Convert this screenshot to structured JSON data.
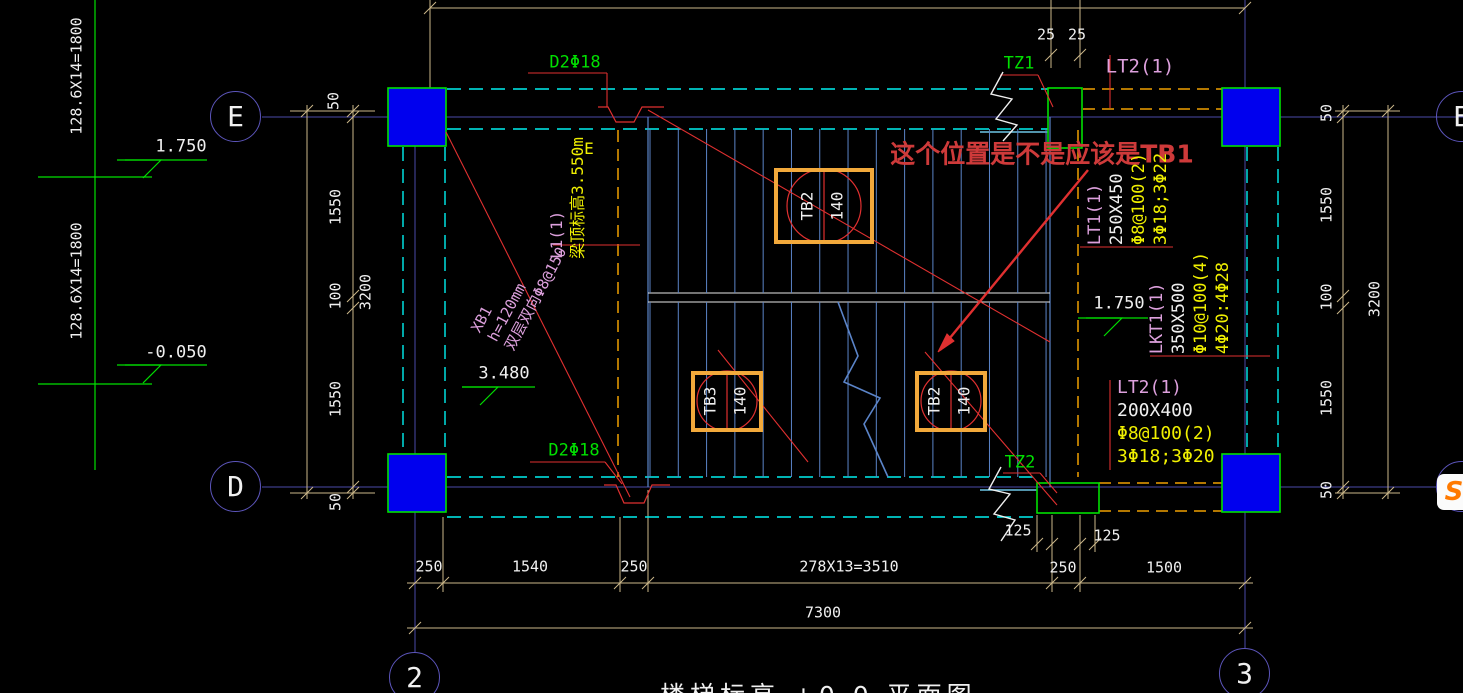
{
  "title_partial": "楼梯标高 +0.0 平面图",
  "overlay_icon": {
    "letter": "S"
  },
  "colors": {
    "background": "#000000",
    "grid": "#4A4AA8",
    "dim": "#CDB88A",
    "text": "#F0F0F0",
    "green": "#00E000",
    "red": "#E03030",
    "pink": "#DDA0DD",
    "yellow": "#F0F000",
    "cyan": "#00F0F0",
    "orange_dash": "#F0A000",
    "tb_border": "#F2A93B",
    "tread_blue": "#5B84C8",
    "column_fill": "#0000EE",
    "note_red": "#CE3A3A"
  },
  "grid_bubbles": [
    {
      "name": "grid-E-left",
      "label": "E",
      "cx": 236,
      "cy": 117
    },
    {
      "name": "grid-D-left",
      "label": "D",
      "cx": 236,
      "cy": 487
    },
    {
      "name": "grid-2",
      "label": "2",
      "cx": 415,
      "cy": 678
    },
    {
      "name": "grid-3",
      "label": "3",
      "cx": 1245,
      "cy": 674
    },
    {
      "name": "grid-E-right",
      "label": "E",
      "cx": 1462,
      "cy": 117
    },
    {
      "name": "grid-D-right",
      "label": "D",
      "cx": 1462,
      "cy": 487
    }
  ],
  "labels": [
    {
      "name": "riser-calc-top",
      "t": "128.6X14=1800",
      "x": 77,
      "y": 76,
      "rot": -90,
      "c": "#F0F0F0",
      "s": 15
    },
    {
      "name": "riser-calc-bottom",
      "t": "128.6X14=1800",
      "x": 77,
      "y": 281,
      "rot": -90,
      "c": "#F0F0F0",
      "s": 15
    },
    {
      "name": "level-1750-left",
      "t": "1.750",
      "x": 181,
      "y": 147,
      "rot": 0,
      "c": "#F0F0F0",
      "s": 17
    },
    {
      "name": "level-neg-0050",
      "t": "-0.050",
      "x": 176,
      "y": 353,
      "rot": 0,
      "c": "#F0F0F0",
      "s": 17
    },
    {
      "name": "level-3480",
      "t": "3.480",
      "x": 504,
      "y": 374,
      "rot": 0,
      "c": "#F0F0F0",
      "s": 17
    },
    {
      "name": "level-1750-right",
      "t": "1.750",
      "x": 1119,
      "y": 304,
      "rot": 0,
      "c": "#F0F0F0",
      "s": 17
    },
    {
      "name": "dim-50-left-top",
      "t": "50",
      "x": 334,
      "y": 101,
      "rot": -90,
      "c": "#F0F0F0",
      "s": 15
    },
    {
      "name": "dim-1550-left-top",
      "t": "1550",
      "x": 336,
      "y": 207,
      "rot": -90,
      "c": "#F0F0F0",
      "s": 15
    },
    {
      "name": "dim-100-left",
      "t": "100",
      "x": 336,
      "y": 296,
      "rot": -90,
      "c": "#F0F0F0",
      "s": 15
    },
    {
      "name": "dim-1550-left-bot",
      "t": "1550",
      "x": 336,
      "y": 399,
      "rot": -90,
      "c": "#F0F0F0",
      "s": 15
    },
    {
      "name": "dim-50-left-bot",
      "t": "50",
      "x": 336,
      "y": 502,
      "rot": -90,
      "c": "#F0F0F0",
      "s": 15
    },
    {
      "name": "dim-3200-left",
      "t": "3200",
      "x": 366,
      "y": 292,
      "rot": -90,
      "c": "#F0F0F0",
      "s": 15
    },
    {
      "name": "dim-50-right-top",
      "t": "50",
      "x": 1327,
      "y": 113,
      "rot": -90,
      "c": "#F0F0F0",
      "s": 15
    },
    {
      "name": "dim-1550-right-top",
      "t": "1550",
      "x": 1327,
      "y": 205,
      "rot": -90,
      "c": "#F0F0F0",
      "s": 15
    },
    {
      "name": "dim-100-right",
      "t": "100",
      "x": 1327,
      "y": 297,
      "rot": -90,
      "c": "#F0F0F0",
      "s": 15
    },
    {
      "name": "dim-1550-right-bot",
      "t": "1550",
      "x": 1327,
      "y": 398,
      "rot": -90,
      "c": "#F0F0F0",
      "s": 15
    },
    {
      "name": "dim-50-right-bot",
      "t": "50",
      "x": 1327,
      "y": 490,
      "rot": -90,
      "c": "#F0F0F0",
      "s": 15
    },
    {
      "name": "dim-3200-right",
      "t": "3200",
      "x": 1375,
      "y": 299,
      "rot": -90,
      "c": "#F0F0F0",
      "s": 15
    },
    {
      "name": "dim-25-a",
      "t": "25",
      "x": 1046,
      "y": 35,
      "rot": 0,
      "c": "#F0F0F0",
      "s": 15
    },
    {
      "name": "dim-25-b",
      "t": "25",
      "x": 1077,
      "y": 35,
      "rot": 0,
      "c": "#F0F0F0",
      "s": 15
    },
    {
      "name": "dim-250-a",
      "t": "250",
      "x": 429,
      "y": 567,
      "rot": 0,
      "c": "#F0F0F0",
      "s": 15
    },
    {
      "name": "dim-1540",
      "t": "1540",
      "x": 530,
      "y": 567,
      "rot": 0,
      "c": "#F0F0F0",
      "s": 15
    },
    {
      "name": "dim-250-b",
      "t": "250",
      "x": 634,
      "y": 567,
      "rot": 0,
      "c": "#F0F0F0",
      "s": 15
    },
    {
      "name": "dim-tread-run",
      "t": "278X13=3510",
      "x": 849,
      "y": 567,
      "rot": 0,
      "c": "#F0F0F0",
      "s": 15
    },
    {
      "name": "dim-250-c",
      "t": "250",
      "x": 1063,
      "y": 568,
      "rot": 0,
      "c": "#F0F0F0",
      "s": 15
    },
    {
      "name": "dim-1500",
      "t": "1500",
      "x": 1164,
      "y": 568,
      "rot": 0,
      "c": "#F0F0F0",
      "s": 15
    },
    {
      "name": "dim-7300",
      "t": "7300",
      "x": 823,
      "y": 613,
      "rot": 0,
      "c": "#F0F0F0",
      "s": 15
    },
    {
      "name": "dim-125-a",
      "t": "125",
      "x": 1018,
      "y": 531,
      "rot": 0,
      "c": "#F0F0F0",
      "s": 15
    },
    {
      "name": "dim-125-b",
      "t": "125",
      "x": 1107,
      "y": 536,
      "rot": 0,
      "c": "#F0F0F0",
      "s": 15
    },
    {
      "name": "rebar-d2-top",
      "t": "D2Φ18",
      "x": 575,
      "y": 63,
      "rot": 0,
      "c": "#00E000",
      "s": 17
    },
    {
      "name": "rebar-d2-bottom",
      "t": "D2Φ18",
      "x": 574,
      "y": 451,
      "rot": 0,
      "c": "#00E000",
      "s": 17
    },
    {
      "name": "col-tz1",
      "t": "TZ1",
      "x": 1019,
      "y": 64,
      "rot": 0,
      "c": "#00E000",
      "s": 17
    },
    {
      "name": "col-tz2",
      "t": "TZ2",
      "x": 1020,
      "y": 463,
      "rot": 0,
      "c": "#00E000",
      "s": 17
    },
    {
      "name": "beam-lt2-top-tag",
      "t": "LT2(1)",
      "x": 1140,
      "y": 67,
      "rot": 0,
      "c": "#DDA0DD",
      "s": 19
    },
    {
      "name": "question-note",
      "t": "这个位置是不是应该是TB1",
      "x": 1042,
      "y": 154,
      "rot": 0,
      "c": "#CE3A3A",
      "s": 25,
      "b": 1
    },
    {
      "name": "label-e-yellow",
      "t": "E",
      "x": 589,
      "y": 149,
      "rot": 0,
      "c": "#F0F000",
      "s": 16
    }
  ],
  "blocks": [
    {
      "name": "beam-lt1-spec",
      "x": 1131,
      "y": 199,
      "rot": -90,
      "lh": 22,
      "s": 17,
      "lines": [
        {
          "t": "LT1(1)",
          "c": "#DDA0DD"
        },
        {
          "t": "250X450",
          "c": "#F0F0F0"
        },
        {
          "t": "Φ8@100(2)",
          "c": "#F0F000"
        },
        {
          "t": "3Φ18;3Φ22",
          "c": "#F0F000"
        }
      ]
    },
    {
      "name": "beam-lkt1-spec",
      "x": 1193,
      "y": 303,
      "rot": -90,
      "lh": 22,
      "s": 17,
      "lines": [
        {
          "t": "LKT1(1)",
          "c": "#DDA0DD"
        },
        {
          "t": "350X500",
          "c": "#F0F0F0"
        },
        {
          "t": "Φ10@100(4)",
          "c": "#F0F000"
        },
        {
          "t": "4Φ20:4Φ28",
          "c": "#F0F000"
        }
      ]
    },
    {
      "name": "beam-lt2-spec",
      "x": 1117,
      "y": 379,
      "rot": 0,
      "lh": 23,
      "s": 18,
      "anchor": "tl",
      "lines": [
        {
          "t": "LT2(1)",
          "c": "#DDA0DD"
        },
        {
          "t": "200X400",
          "c": "#F0F0F0"
        },
        {
          "t": "Φ8@100(2)",
          "c": "#F0F000"
        },
        {
          "t": "3Φ18;3Φ20",
          "c": "#F0F000"
        }
      ]
    },
    {
      "name": "beam-l1-spec",
      "x": 570,
      "y": 198,
      "rot": -90,
      "lh": 21,
      "s": 16,
      "lines": [
        {
          "t": "L1(1)",
          "c": "#DDA0DD"
        },
        {
          "t": "梁顶标高3.550m",
          "c": "#F0F000"
        }
      ]
    },
    {
      "name": "slab-xb1-spec",
      "x": 521,
      "y": 291,
      "rot": -62,
      "lh": 19,
      "s": 15,
      "lines": [
        {
          "t": "XB1",
          "c": "#DDA0DD"
        },
        {
          "t": "h=120mm",
          "c": "#DDA0DD"
        },
        {
          "t": "双层双向Φ8@150",
          "c": "#DDA0DD"
        }
      ]
    }
  ],
  "tb_boxes": [
    {
      "name": "slab-tag-tb2-top",
      "label": "TB2",
      "thick": "140",
      "x": 824,
      "y": 206,
      "w": 100,
      "h": 76,
      "r": 37
    },
    {
      "name": "slab-tag-tb3",
      "label": "TB3",
      "thick": "140",
      "x": 727,
      "y": 401,
      "w": 72,
      "h": 61,
      "r": 30
    },
    {
      "name": "slab-tag-tb2-bottom",
      "label": "TB2",
      "thick": "140",
      "x": 951,
      "y": 401,
      "w": 72,
      "h": 61,
      "r": 30
    }
  ]
}
